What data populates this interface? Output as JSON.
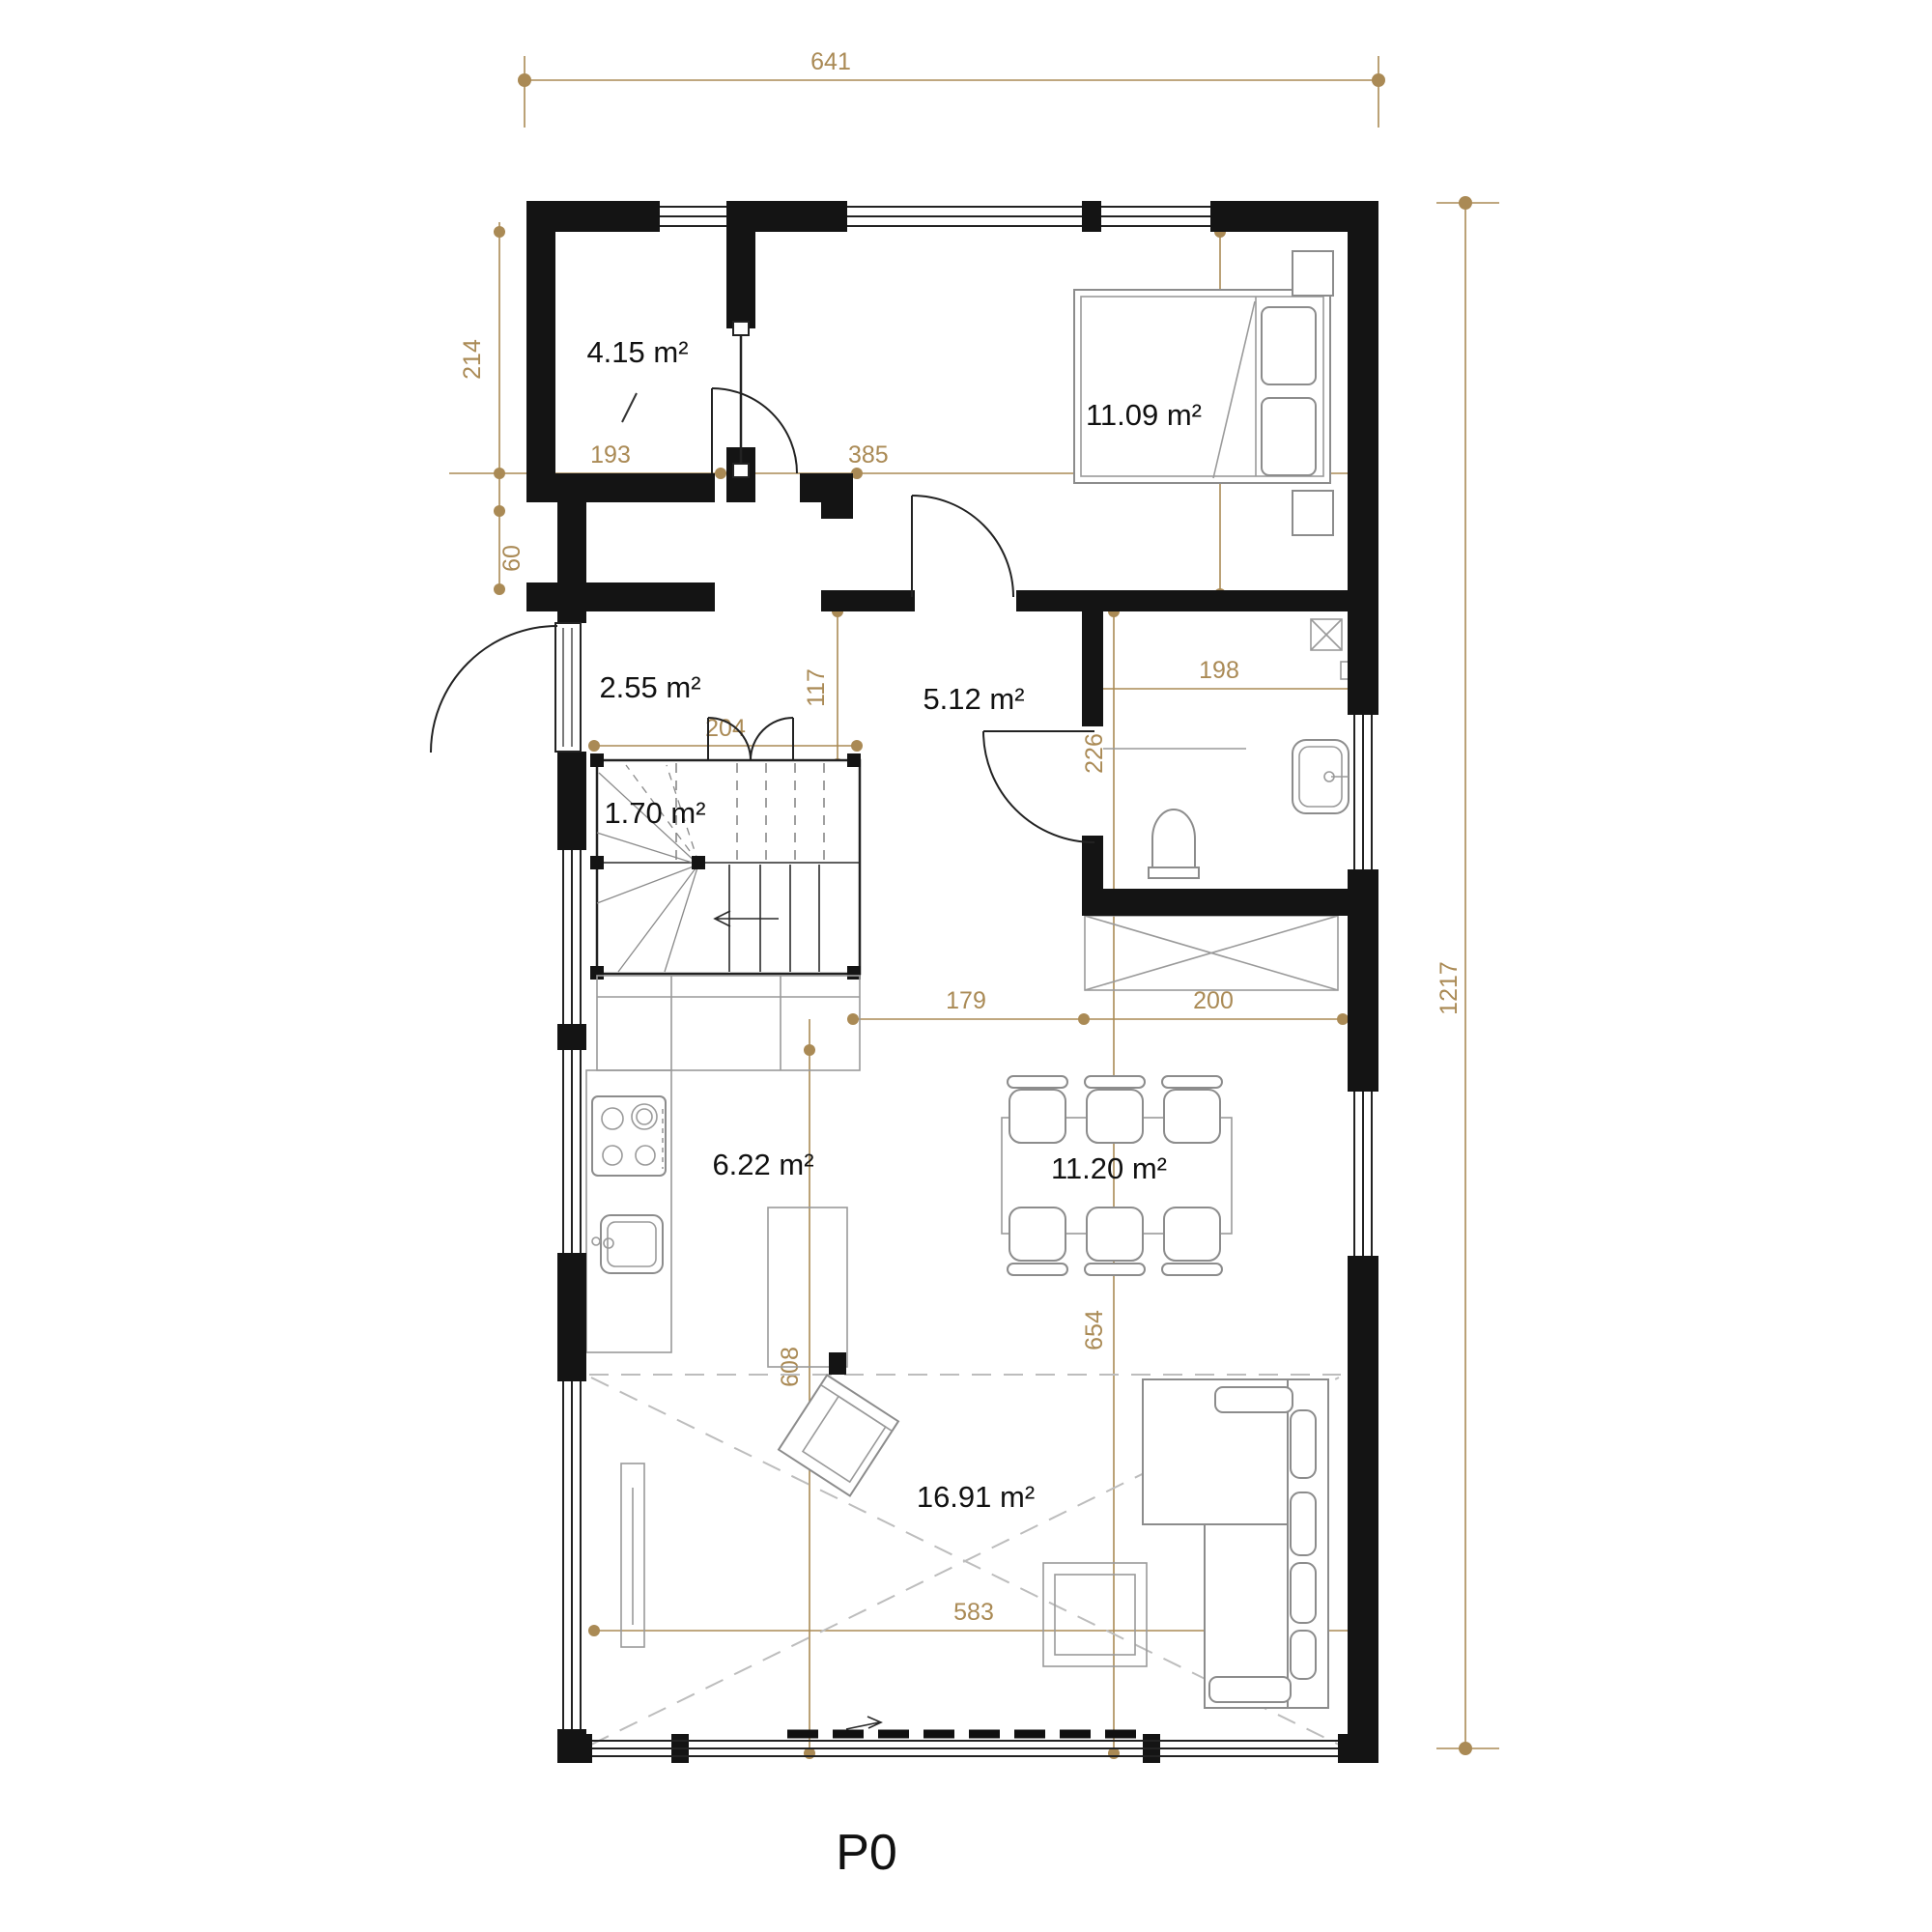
{
  "floor_label": "P0",
  "colors": {
    "dimension_accent": "#aa8a55",
    "wall": "#141414",
    "furniture_outline": "#8c8c8c"
  },
  "rooms": {
    "storage": {
      "area": "4.15 m²"
    },
    "bedroom": {
      "area": "11.09 m²"
    },
    "entry": {
      "area": "2.55 m²"
    },
    "hall": {
      "area": "5.12 m²"
    },
    "stairs": {
      "area": "1.70 m²"
    },
    "kitchen": {
      "area": "6.22 m²"
    },
    "dining": {
      "area": "11.20 m²"
    },
    "living": {
      "area": "16.91 m²"
    }
  },
  "dimensions": {
    "overall_width": "641",
    "overall_height": "1217",
    "storage_height": "214",
    "storage_width": "193",
    "bedroom_width": "385",
    "bedroom_height": "288",
    "niche_height": "60",
    "entry_width": "204",
    "stair_offset": "117",
    "bathroom_width": "198",
    "bathroom_height": "226",
    "hall_width": "179",
    "closet_width": "200",
    "dining_span": "654",
    "kitchen_span": "608",
    "living_width": "583"
  }
}
